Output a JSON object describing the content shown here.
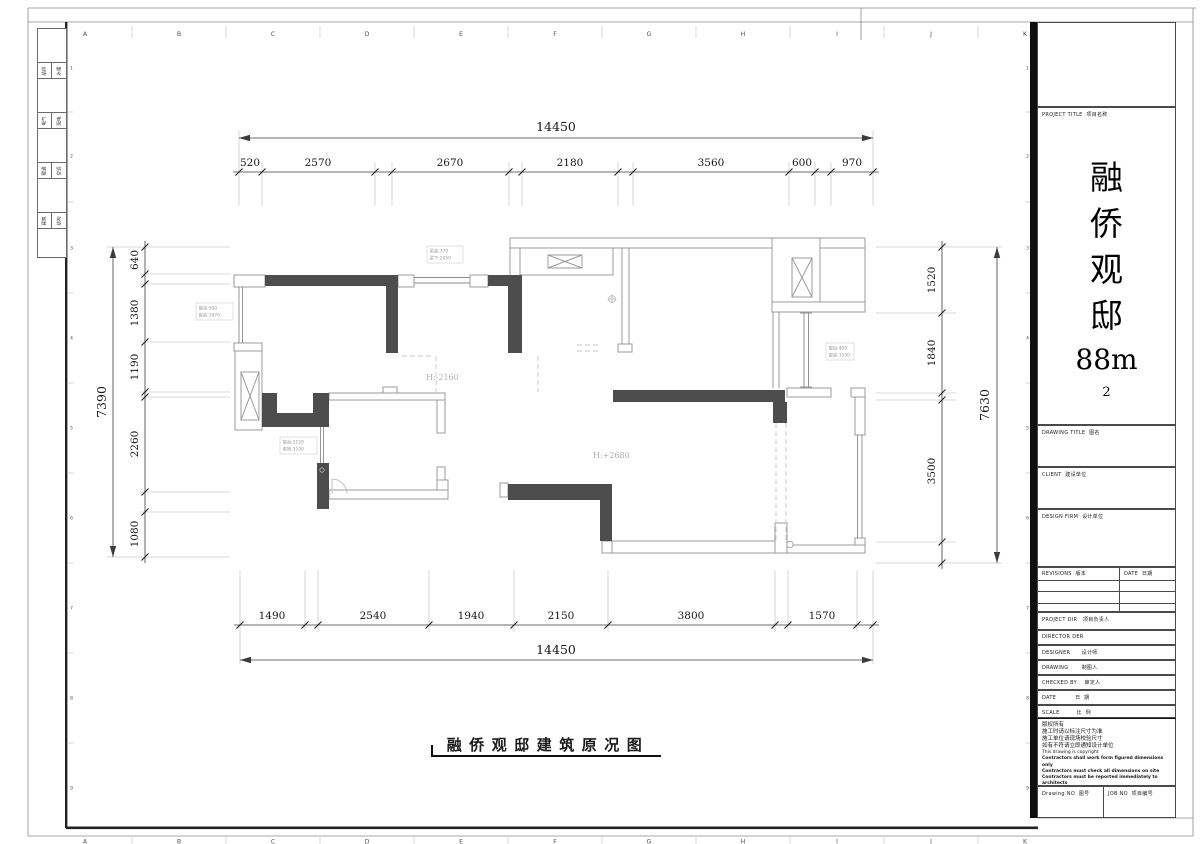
{
  "caption": "融侨观邸建筑原况图",
  "grid": {
    "letters": [
      "A",
      "B",
      "C",
      "D",
      "E",
      "F",
      "G",
      "H",
      "I",
      "J",
      "K"
    ],
    "numbers": [
      "1",
      "2",
      "3",
      "4",
      "5",
      "6",
      "7",
      "8",
      "9"
    ]
  },
  "frame": {
    "signature_rows": [
      [
        "给排",
        "水暖"
      ],
      [
        "电气",
        "配电"
      ],
      [
        "暖通",
        "空调"
      ],
      [
        "建筑",
        "结构"
      ]
    ]
  },
  "title_block": {
    "project_title_label": "PROJECT TITLE  项目名称",
    "project_title_chars": [
      "融",
      "侨",
      "观",
      "邸",
      "88m",
      "2"
    ],
    "drawing_title_label": "DRAWING TITLE  图名",
    "client_label": "CLIENT  建设单位",
    "design_firm_label": "DESIGN FIRM  设计单位",
    "revisions_label": "REVISIONS  版本",
    "date_col_label": "DATE  日期",
    "project_dir_label": "PROJECT DIR   项目负责人",
    "director_label": "DIRECTOR DER",
    "designer_label": "DESIGNER      设计师",
    "drawing_label": "DRAWING       制图人",
    "checked_label": "CHECKED BY    审定人",
    "date_label": "DATE          日  期",
    "scale_label": "SCALE         比  例",
    "notes": [
      "版权所有",
      "施工时请以标注尺寸为准",
      "施工单位请现场校验尺寸",
      "如有不符请立即通知设计单位",
      "This drawing is copyright",
      "Contractors shall work form figured dimensions only",
      "Contractors must check all dimensions on site",
      "Contractors must be reported immediately to architects"
    ],
    "drawing_no_label": "Drawing NO  图号",
    "job_no_label": "JOB NO  项目编号"
  },
  "plan": {
    "height_labels": [
      {
        "text": "H:-2160",
        "x": 426,
        "y": 380
      },
      {
        "text": "H:+2680",
        "x": 593,
        "y": 458
      }
    ],
    "tags": [
      {
        "x": 427,
        "y": 246,
        "w": 36,
        "h": 17,
        "lines": [
          "梁高:370",
          "梁下:2050"
        ]
      },
      {
        "x": 196,
        "y": 303,
        "w": 37,
        "h": 17,
        "lines": [
          "窗台:500",
          "窗高:1970"
        ]
      },
      {
        "x": 826,
        "y": 343,
        "w": 28,
        "h": 17,
        "lines": [
          "窗台:400",
          "窗高:1500"
        ]
      },
      {
        "x": 280,
        "y": 437,
        "w": 37,
        "h": 17,
        "lines": [
          "窗台:2120",
          "离地:1100"
        ]
      }
    ]
  },
  "dims": {
    "top": {
      "orient": "h",
      "chain": {
        "pos": 172,
        "label_pos": 166,
        "ticks": [
          239,
          262,
          375,
          392,
          509,
          522,
          618,
          633,
          789,
          815,
          831,
          873
        ],
        "segments": [
          {
            "label": "520",
            "mid": 250
          },
          {
            "label": "2570",
            "mid": 318
          },
          {
            "label": "2670",
            "mid": 450
          },
          {
            "label": "2180",
            "mid": 570
          },
          {
            "label": "3560",
            "mid": 711
          },
          {
            "label": "600",
            "mid": 802
          },
          {
            "label": "970",
            "mid": 852
          }
        ]
      },
      "total": {
        "label": "14450",
        "pos": 138,
        "from": 239,
        "to": 873,
        "label_at": 556,
        "label_pos": 131
      },
      "ext": {
        "mid": [
          162,
          206
        ],
        "end": [
          130,
          206
        ]
      }
    },
    "bottom": {
      "orient": "h",
      "chain": {
        "pos": 625,
        "label_pos": 619,
        "ticks": [
          240,
          305,
          318,
          429,
          514,
          608,
          775,
          788,
          857,
          873
        ],
        "segments": [
          {
            "label": "1490",
            "mid": 272
          },
          {
            "label": "2540",
            "mid": 373
          },
          {
            "label": "1940",
            "mid": 471
          },
          {
            "label": "2150",
            "mid": 561
          },
          {
            "label": "3800",
            "mid": 691
          },
          {
            "label": "1570",
            "mid": 822
          }
        ]
      },
      "total": {
        "label": "14450",
        "pos": 660,
        "from": 240,
        "to": 873,
        "label_at": 556,
        "label_pos": 654
      },
      "ext": {
        "mid": [
          570,
          632
        ],
        "end": [
          570,
          664
        ]
      }
    },
    "left": {
      "orient": "v",
      "chain": {
        "pos": 145,
        "label_pos": 138,
        "ticks": [
          247,
          274,
          284,
          342,
          392,
          397,
          492,
          512,
          557
        ],
        "segments": [
          {
            "label": "640",
            "mid": 260
          },
          {
            "label": "1380",
            "mid": 313
          },
          {
            "label": "1190",
            "mid": 367
          },
          {
            "label": "2260",
            "mid": 444
          },
          {
            "label": "1080",
            "mid": 534
          }
        ]
      },
      "total": {
        "label": "7390",
        "pos": 113,
        "from": 247,
        "to": 557,
        "label_at": 402,
        "label_pos": 106
      },
      "ext": {
        "mid": [
          140,
          230
        ],
        "end": [
          107,
          230
        ]
      }
    },
    "right": {
      "orient": "v",
      "chain": {
        "pos": 942,
        "label_pos": 935,
        "ticks": [
          247,
          313,
          393,
          400,
          542,
          563
        ],
        "segments": [
          {
            "label": "1520",
            "mid": 280
          },
          {
            "label": "1840",
            "mid": 353
          },
          {
            "label": "3500",
            "mid": 471
          }
        ]
      },
      "total": {
        "label": "7630",
        "pos": 997,
        "from": 247,
        "to": 563,
        "label_at": 405,
        "label_pos": 989
      },
      "ext": {
        "mid": [
          876,
          956
        ],
        "end": [
          876,
          1002
        ]
      }
    }
  }
}
